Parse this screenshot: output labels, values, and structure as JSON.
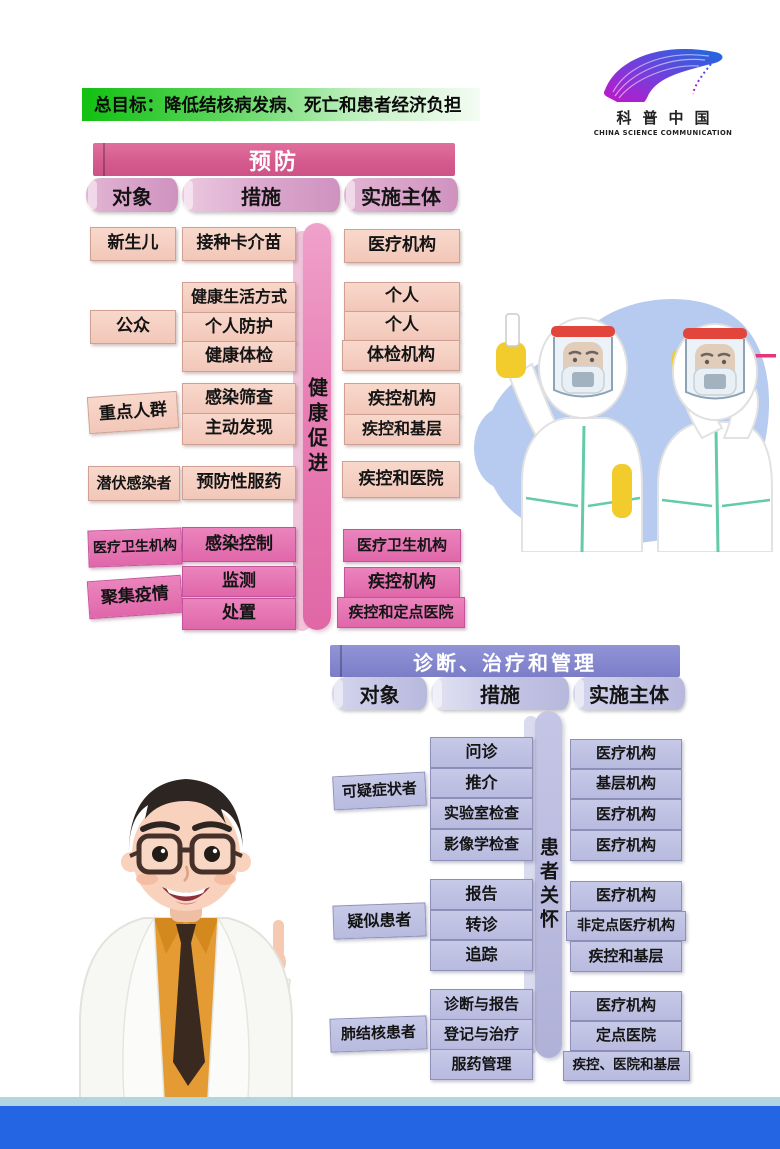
{
  "banner": {
    "text": "总目标：降低结核病发病、死亡和患者经济负担"
  },
  "logo": {
    "cn": "科普中国",
    "en": "CHINA SCIENCE COMMUNICATION"
  },
  "prevention": {
    "title": "预防",
    "columns": {
      "object": "对象",
      "measures": "措施",
      "implementer": "实施主体"
    },
    "side_label": "健康促进",
    "objects": [
      "新生儿",
      "公众",
      "重点人群",
      "潜伏感染者",
      "医疗卫生机构",
      "聚集疫情"
    ],
    "measures": [
      "接种卡介苗",
      "健康生活方式",
      "个人防护",
      "健康体检",
      "感染筛查",
      "主动发现",
      "预防性服药",
      "感染控制",
      "监测",
      "处置"
    ],
    "implementers": [
      "医疗机构",
      "个人",
      "个人",
      "体检机构",
      "疾控机构",
      "疾控和基层",
      "疾控和医院",
      "医疗卫生机构",
      "疾控机构",
      "疾控和定点医院"
    ]
  },
  "diagnosis": {
    "title": "诊断、治疗和管理",
    "columns": {
      "object": "对象",
      "measures": "措施",
      "implementer": "实施主体"
    },
    "side_label": "患者关怀",
    "objects": [
      "可疑症状者",
      "疑似患者",
      "肺结核患者"
    ],
    "measures": [
      "问诊",
      "推介",
      "实验室检查",
      "影像学检查",
      "报告",
      "转诊",
      "追踪",
      "诊断与报告",
      "登记与治疗",
      "服药管理"
    ],
    "implementers": [
      "医疗机构",
      "基层机构",
      "医疗机构",
      "医疗机构",
      "医疗机构",
      "非定点医疗机构",
      "疾控和基层",
      "医疗机构",
      "定点医院",
      "疾控、医院和基层"
    ]
  },
  "colors": {
    "banner_green": "#1fc41f",
    "prevention_pink": "#d4588b",
    "prevention_box_light": "#f5cec1",
    "prevention_box_dark": "#e36fb0",
    "diagnosis_purple": "#8286cb",
    "diagnosis_box": "#bfc1e3",
    "footer_blue": "#2365e2",
    "footer_strip": "#b2d5e2",
    "illustration_blue": "#b6cbef"
  }
}
